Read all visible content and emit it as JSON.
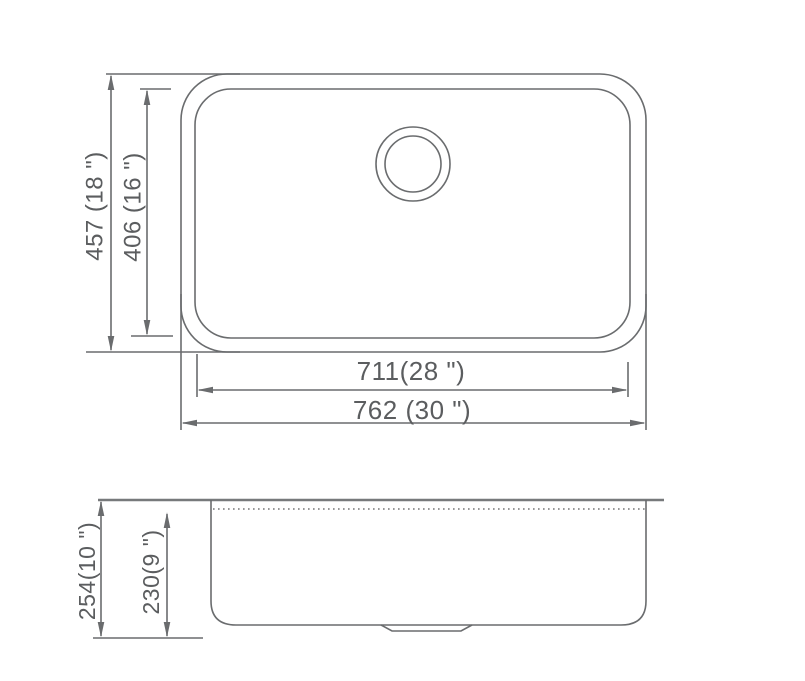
{
  "colors": {
    "background": "#ffffff",
    "line": "#6a6c6e",
    "text": "#5b5d5f"
  },
  "top_view": {
    "dim_overall_height": "457 (18 \")",
    "dim_bowl_height": "406 (16 \")",
    "dim_bowl_width": "711(28 \")",
    "dim_overall_width": "762 (30 \")"
  },
  "side_view": {
    "dim_overall_depth": "254(10 \")",
    "dim_bowl_depth": "230(9 \")"
  }
}
